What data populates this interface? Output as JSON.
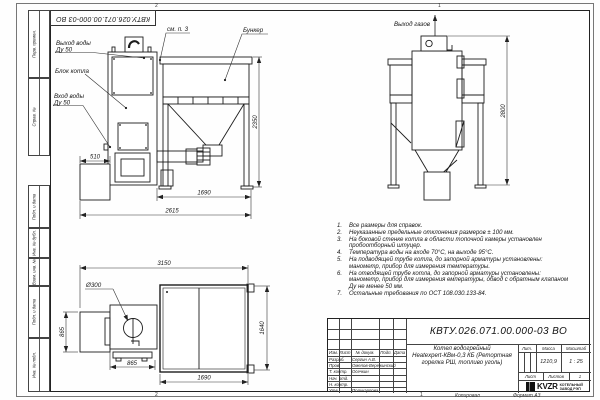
{
  "frame": {
    "top_designation": "КВТУ.026.071.00.000-03 ВО",
    "labels": {
      "perv": "Перв. примен.",
      "sprav": "Справ. №",
      "podp1": "Подп. и дата",
      "inv_dubl": "Инв. № дубл.",
      "vzam": "Взам. инв. №",
      "podp2": "Подп. и дата",
      "inv_podl": "Инв. № подл."
    },
    "zones": {
      "t1": "2",
      "t2": "1",
      "b1": "2",
      "b2": "1"
    },
    "footer": {
      "copied": "Копировал",
      "format": "Формат А3"
    }
  },
  "front_view": {
    "labels": {
      "water_out_1": "Выход воды",
      "water_out_2": "Ду 50",
      "boiler_block": "Блок котла",
      "water_in_1": "Вход воды",
      "water_in_2": "Ду 50",
      "see_note": "см. п. 3",
      "hopper": "Бункер"
    },
    "dims": {
      "height": "2350",
      "base": "510",
      "hopper_width": "1690",
      "total_width": "2615"
    }
  },
  "side_view": {
    "labels": {
      "gas_out": "Выход газов"
    },
    "dims": {
      "height": "2800"
    }
  },
  "plan_view": {
    "labels": {
      "diameter": "Ø300"
    },
    "dims": {
      "total_width": "3150",
      "left_depth": "865",
      "right_depth": "1640",
      "boiler_width": "865",
      "hopper_width": "1690"
    }
  },
  "notes": [
    {
      "num": "1.",
      "text": "Все размеры для справок."
    },
    {
      "num": "2.",
      "text": "Неуказанные предельные отклонения размеров ± 100 мм."
    },
    {
      "num": "3.",
      "text": "На боковой стенке котла в области топочной камеры установлен пробоотборный штуцер."
    },
    {
      "num": "4.",
      "text": "Температура воды на входе 70°С, на выходе 95°С."
    },
    {
      "num": "5.",
      "text": "На подводящей трубе котла, до запорной арматуры установлены: манометр, прибор для измерения температуры."
    },
    {
      "num": "6.",
      "text": "На отводящей трубе котла, до запорной арматуры установлены: манометр, прибор для измерения емпературы, обвод с обратным клапаном Ду не менее 50 мм."
    },
    {
      "num": "7.",
      "text": "Остальные требования по ОСТ 108.030.133-84."
    }
  ],
  "title_block": {
    "designation": "КВТУ.026.071.00.000-03 ВО",
    "name_line1": "Котел водогрейный",
    "name_line2": "Heatexpert-КВм-0,3 КБ (Ретортная",
    "name_line3": "горелка РШ, топливо уголь)",
    "header": {
      "izm": "Изм.",
      "list": "Лист",
      "doc": "№ докум.",
      "sign": "Подп.",
      "date": "Дата"
    },
    "rows": [
      {
        "role": "Разраб.",
        "name": "Сергин А.В."
      },
      {
        "role": "Пров.",
        "name": "Омелов-Вережинский"
      },
      {
        "role": "Т. контр.",
        "name": "Осечкин"
      },
      {
        "role": "Нач. отд.",
        "name": ""
      },
      {
        "role": "Н. контр.",
        "name": ""
      },
      {
        "role": "Утв.",
        "name": "Поликарпова"
      }
    ],
    "lit_label": "Лит.",
    "mass_label": "Масса",
    "scale_label": "Масштаб",
    "mass_value": "1210,9",
    "scale_value": "1 : 25",
    "sheet_label": "Лист",
    "sheets_label": "Листов",
    "sheets_value": "1",
    "logo_text": "KVZR",
    "company_line1": "КОТЕЛЬНЫЙ",
    "company_line2": "ЗАВОД РЭП"
  }
}
